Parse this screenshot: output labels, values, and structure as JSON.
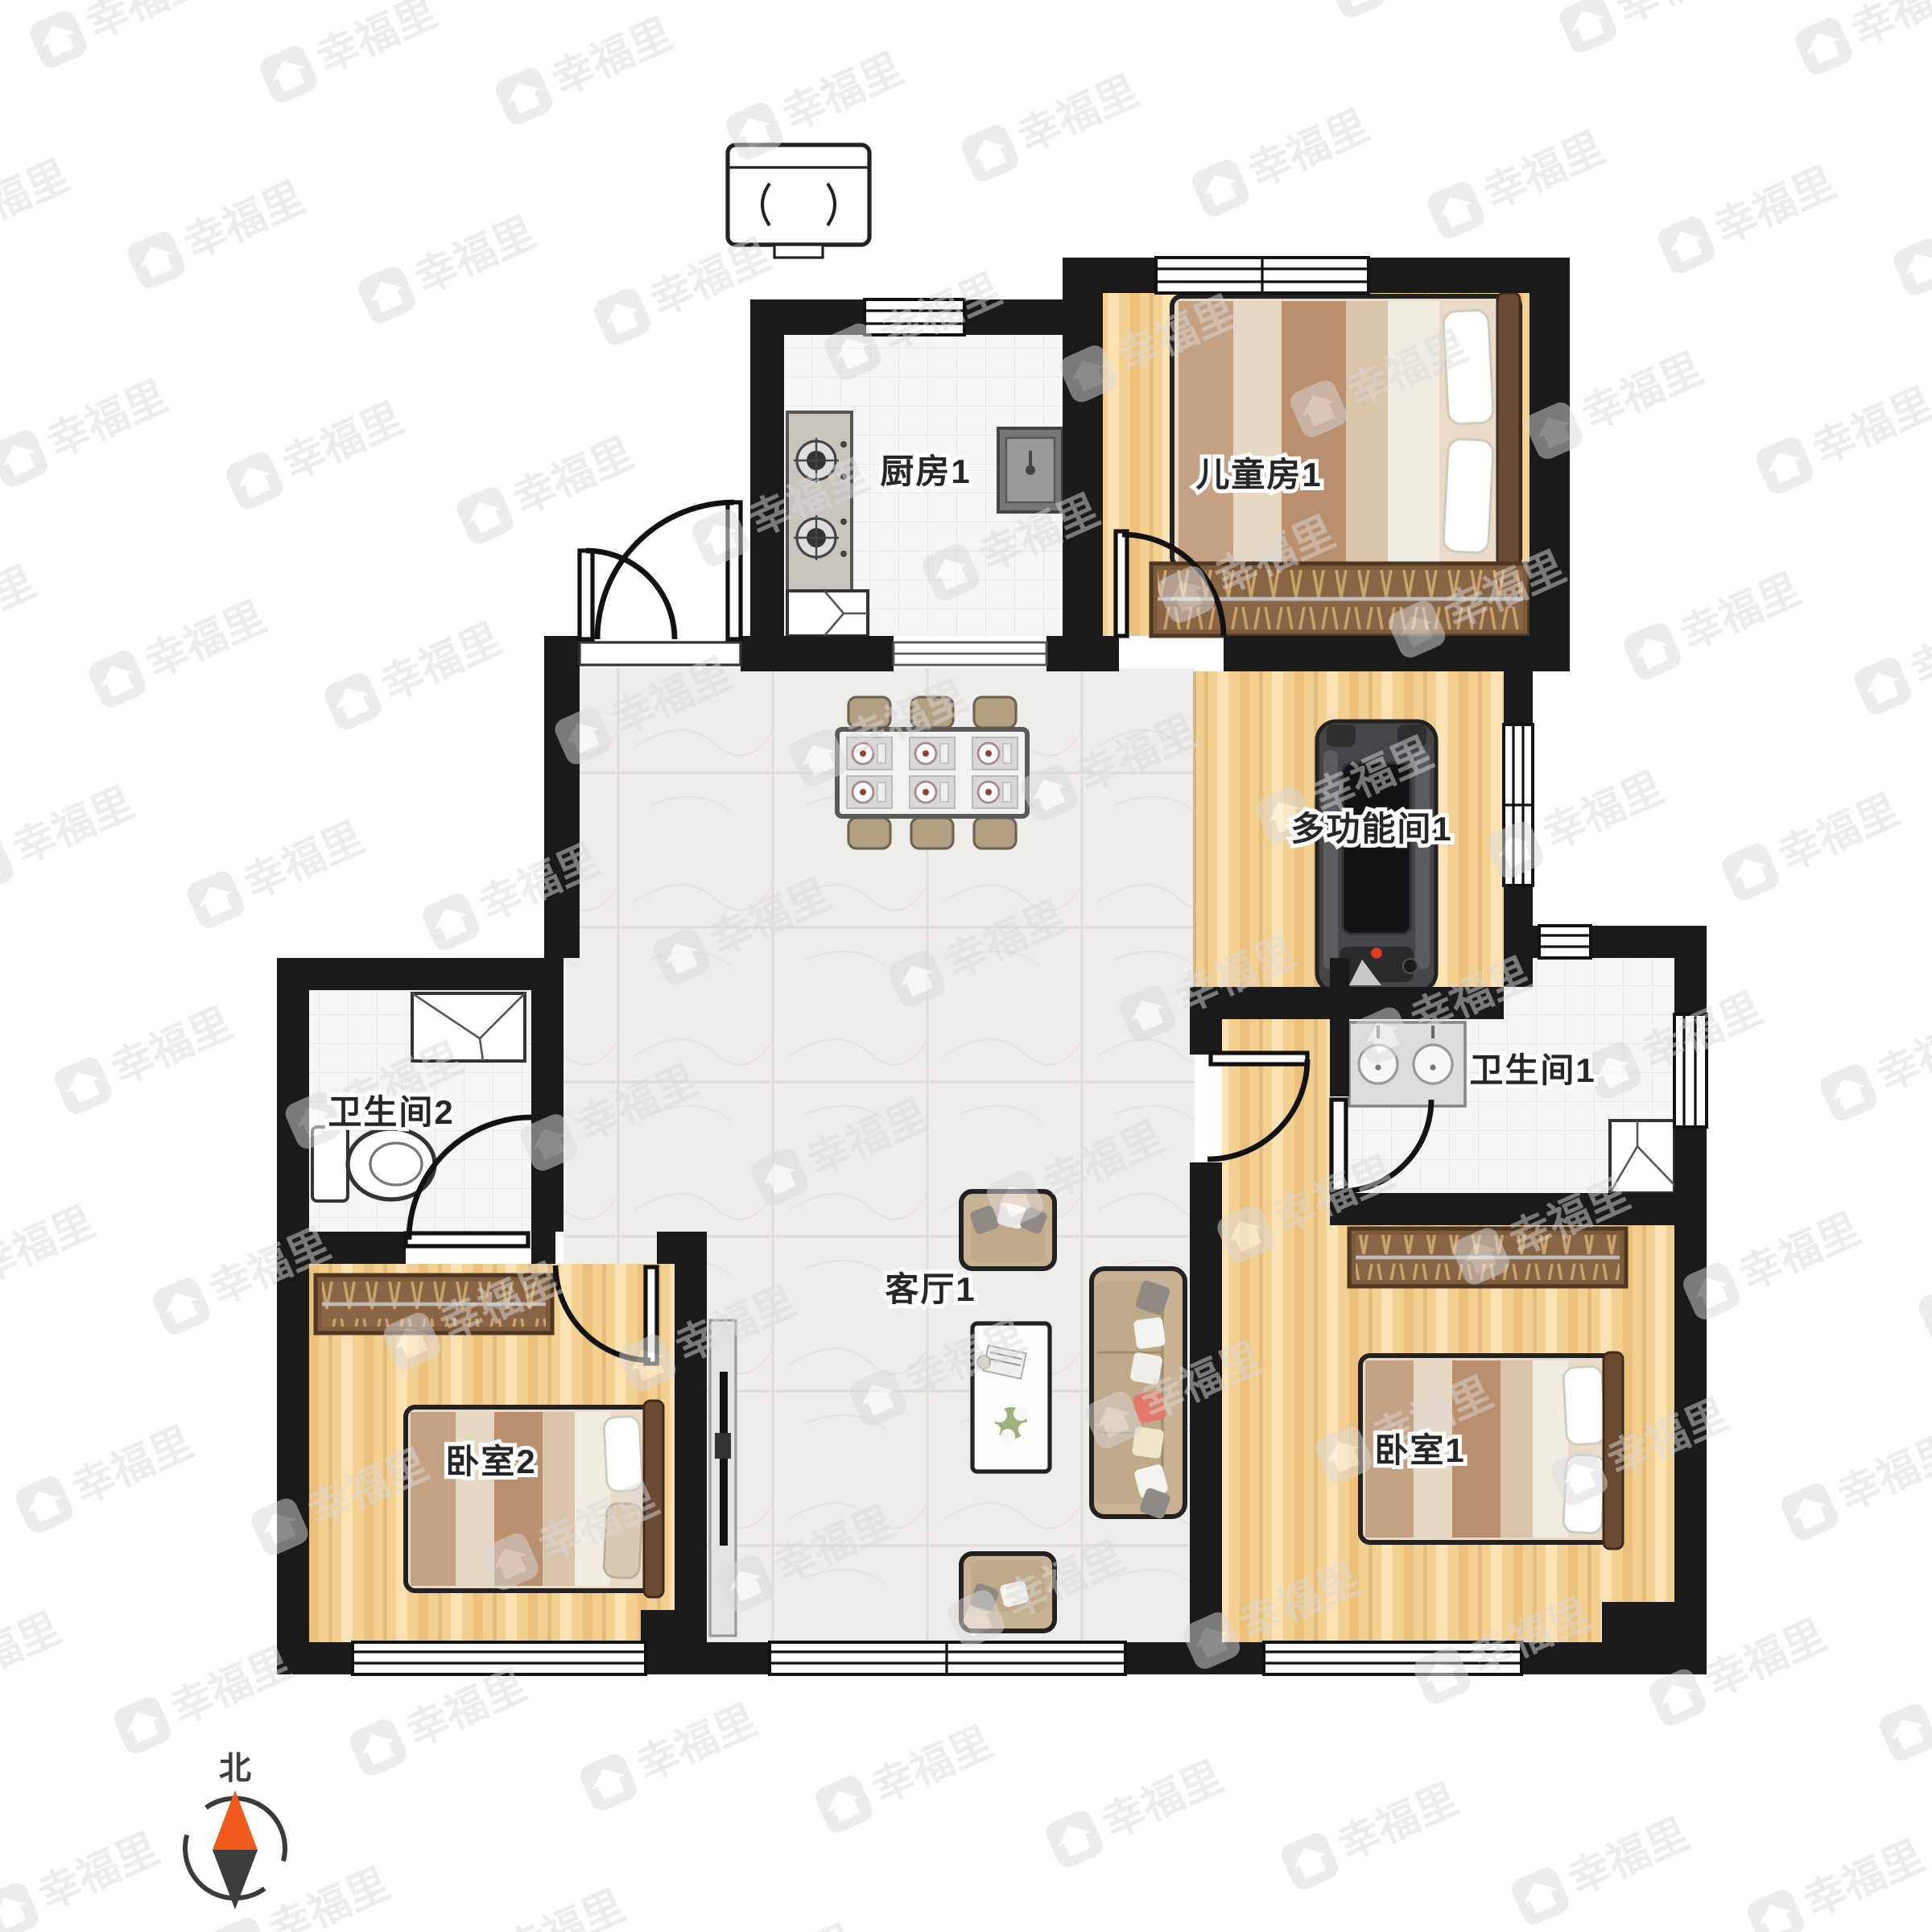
{
  "plan": {
    "rooms": {
      "kitchen": {
        "label": "厨房1"
      },
      "kids_room": {
        "label": "儿童房1"
      },
      "multi_room": {
        "label": "多功能间1"
      },
      "bathroom2": {
        "label": "卫生间2"
      },
      "bathroom1": {
        "label": "卫生间1"
      },
      "living_room": {
        "label": "客厅1"
      },
      "bedroom2": {
        "label": "卧室2"
      },
      "bedroom1": {
        "label": "卧室1"
      }
    },
    "compass": {
      "north_label": "北"
    },
    "watermark": {
      "brand_text": "幸福里"
    },
    "colors": {
      "wall": "#1a1a1a",
      "wood_floor": "#f3cf90",
      "marble_floor": "#efedea",
      "tile_floor": "#f5f5f3",
      "wardrobe_brown": "#7d5a3a",
      "sofa_tan": "#c8b294",
      "treadmill_gray": "#46464a",
      "compass_north": "#f0581c",
      "compass_south": "#3c3c3c",
      "watermark_gray": "#d9d9d9"
    },
    "glyphs": [
      "range-hood-unit",
      "gas-stove",
      "kitchen-sink",
      "corner-cabinet",
      "double-bed",
      "wardrobe",
      "dining-table-6-seats",
      "treadmill",
      "double-sink-counter",
      "shower",
      "toilet",
      "vanity-sink",
      "tv-cabinet",
      "sofa",
      "coffee-table",
      "armchair",
      "compass-north"
    ]
  }
}
